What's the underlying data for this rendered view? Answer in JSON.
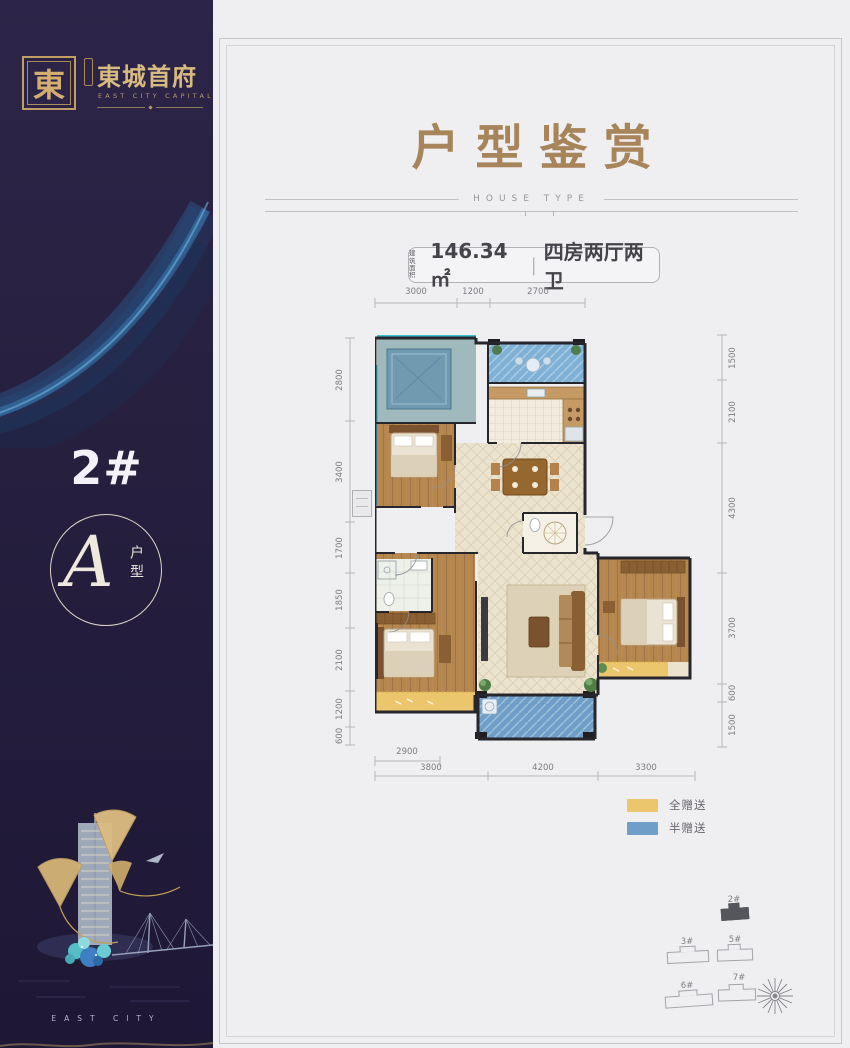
{
  "colors": {
    "sidebar_purple": "#27203f",
    "brand_gold": "#c9a468",
    "title_gold": "#a8845a",
    "legend_full_gift": "#ecc66c",
    "legend_half_gift": "#6f9fc8",
    "window_cyan": "#38c3cf",
    "panel_bg": "#efeff1"
  },
  "sidebar": {
    "seal_char": "東",
    "brand_name": "東城首府",
    "brand_en": "EAST CITY CAPITAL",
    "building_no": "2#",
    "unit_letter": "A",
    "unit_suffix": "户型",
    "footer_caption": "EAST CITY"
  },
  "main": {
    "title": "户型鉴赏",
    "subtitle": "HOUSE TYPE",
    "area_badge": {
      "prefix_line1": "建筑",
      "prefix_line2": "面积",
      "area_value": "146.34㎡",
      "separator": "|",
      "layout_desc": "四房两厅两卫"
    }
  },
  "floorplan": {
    "dims_top": [
      "3000",
      "1200",
      "2700"
    ],
    "dims_left": [
      "2800",
      "3400",
      "1700",
      "1850",
      "2100",
      "1200",
      "600"
    ],
    "dims_right": [
      "1500",
      "2100",
      "4300",
      "3700",
      "600",
      "1500"
    ],
    "dims_bottom_inner": [
      "2900"
    ],
    "dims_bottom_outer": [
      "3800",
      "4200",
      "3300"
    ],
    "legend": [
      {
        "label": "全赠送",
        "color": "#ecc66c"
      },
      {
        "label": "半赠送",
        "color": "#6f9fc8"
      }
    ]
  },
  "sitemap": {
    "buildings": [
      {
        "id": "2#",
        "highlighted": true
      },
      {
        "id": "3#",
        "highlighted": false
      },
      {
        "id": "5#",
        "highlighted": false
      },
      {
        "id": "6#",
        "highlighted": false
      },
      {
        "id": "7#",
        "highlighted": false
      }
    ]
  }
}
